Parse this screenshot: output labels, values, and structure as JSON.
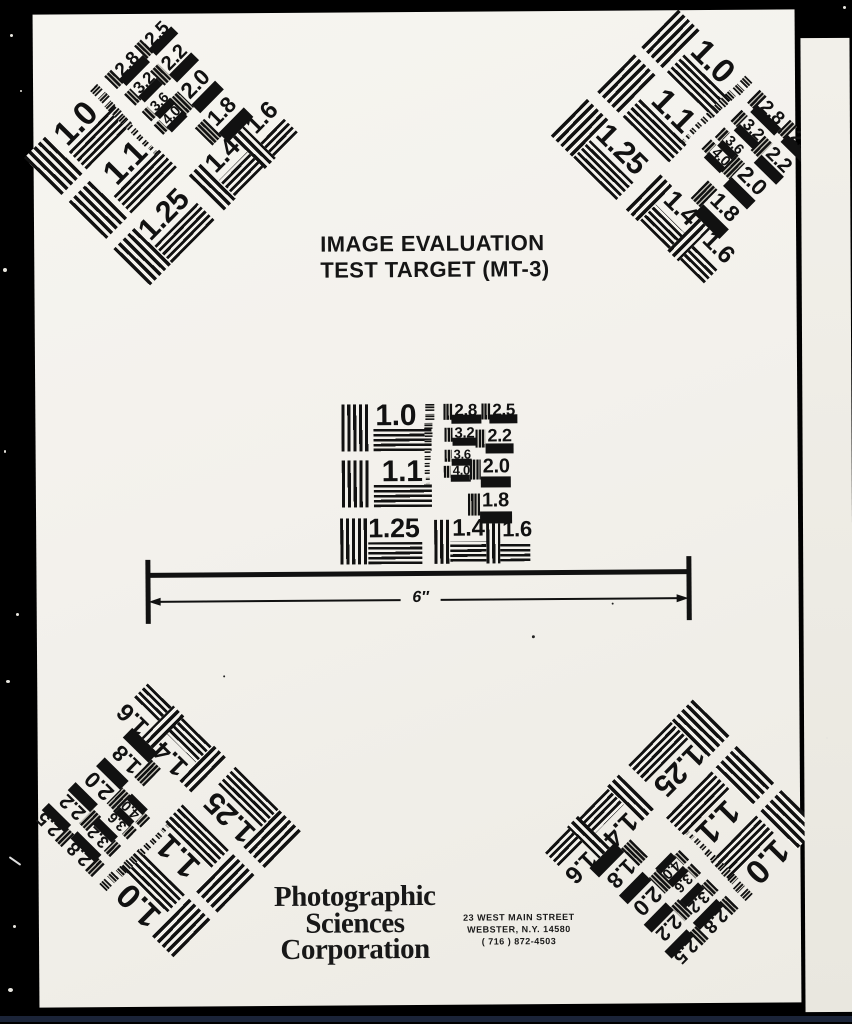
{
  "scan": {
    "title": {
      "line1": "IMAGE EVALUATION",
      "line2": "TEST TARGET (MT-3)"
    },
    "ruler": {
      "label": "6″"
    },
    "footer": {
      "company": {
        "line1": "Photographic",
        "line2": "Sciences",
        "line3": "Corporation"
      },
      "address": {
        "line1": "23 WEST MAIN STREET",
        "line2": "WEBSTER, N.Y. 14580",
        "line3": "( 716 ) 872-4503"
      }
    }
  },
  "pattern": {
    "values": [
      "1.0",
      "1.1",
      "1.25",
      "1.4",
      "1.6",
      "1.8",
      "2.0",
      "2.2",
      "2.5",
      "2.8",
      "3.2",
      "3.6",
      "4.0"
    ]
  },
  "colors": {
    "paper": "#f3f1ec",
    "ink": "#111111",
    "scan_background": "#000000",
    "bottom_edge_line": "#1b2438"
  }
}
